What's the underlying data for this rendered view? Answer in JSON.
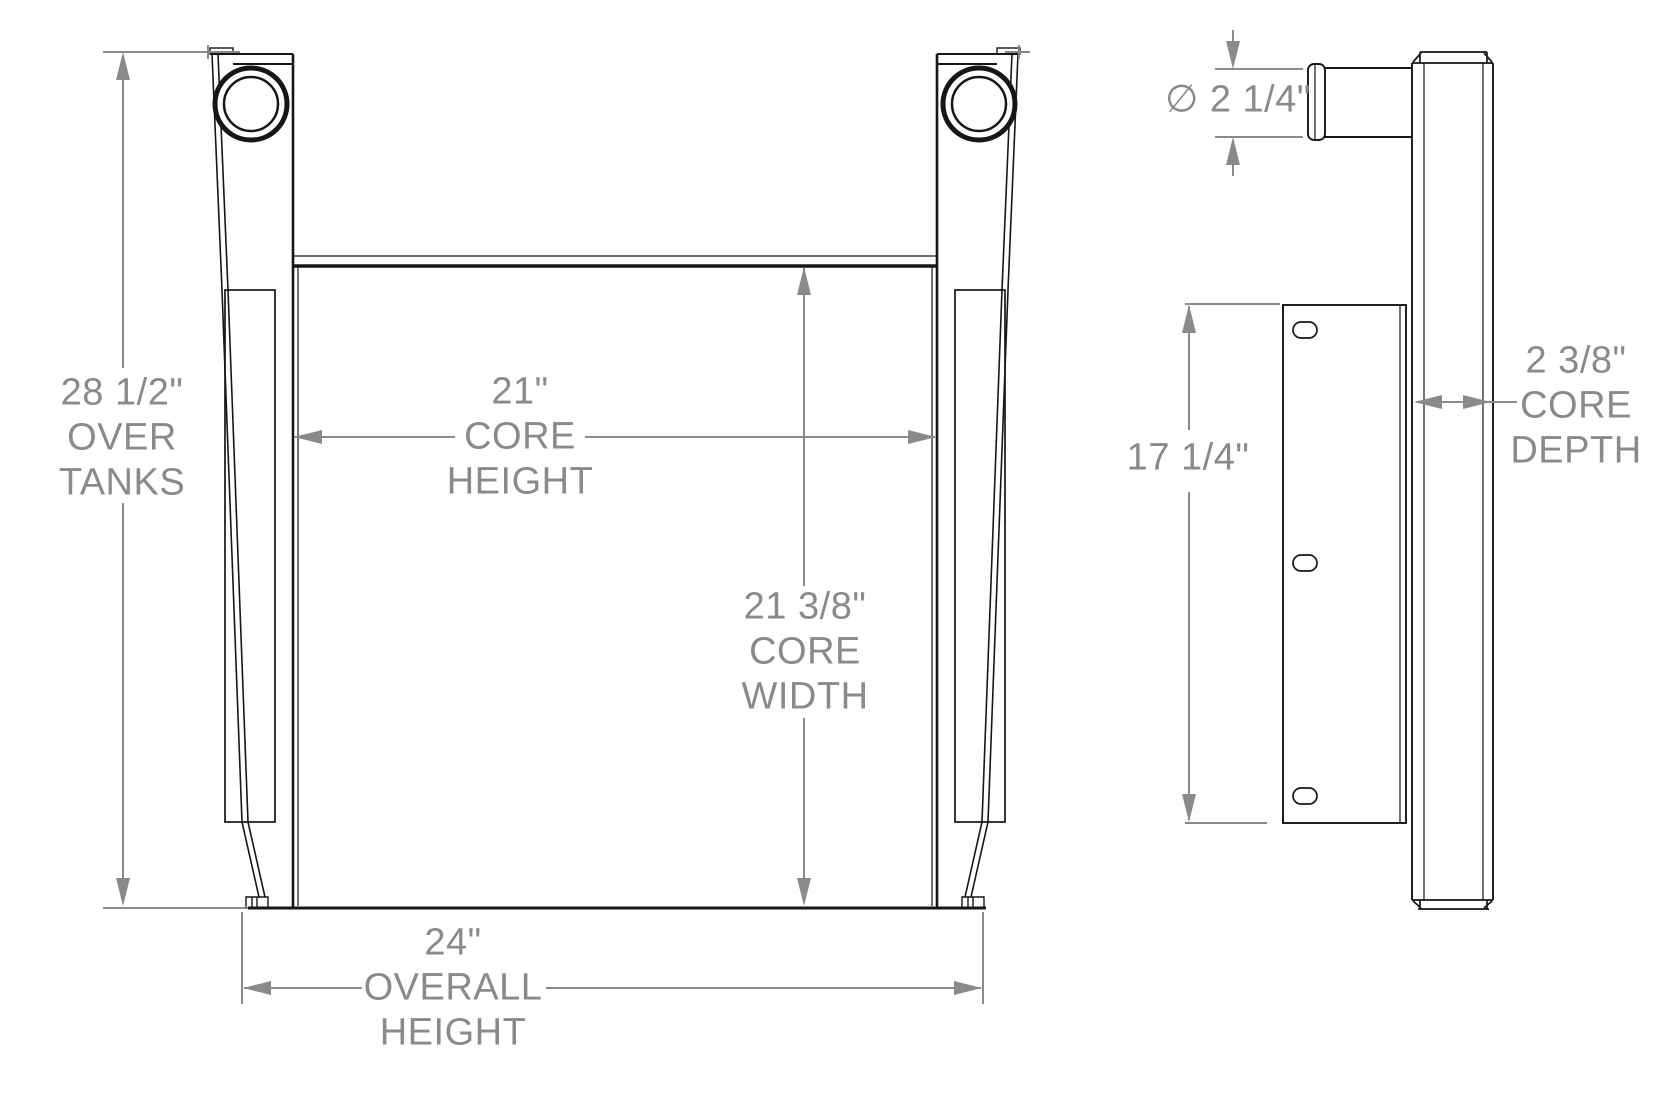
{
  "colors": {
    "paper": "#ffffff",
    "ink": "#161616",
    "dimension": "#8a8a8a"
  },
  "labels": {
    "over_tanks": "28 1/2\"\nOVER\nTANKS",
    "core_height": "21\"\nCORE\nHEIGHT",
    "core_width": "21 3/8\"\nCORE\nWIDTH",
    "overall_height": "24\"\nOVERALL\nHEIGHT",
    "tube_diameter": "∅ 2 1/4\"",
    "mount_plate_height": "17 1/4\"",
    "core_depth": "2 3/8\"\nCORE\nDEPTH"
  }
}
